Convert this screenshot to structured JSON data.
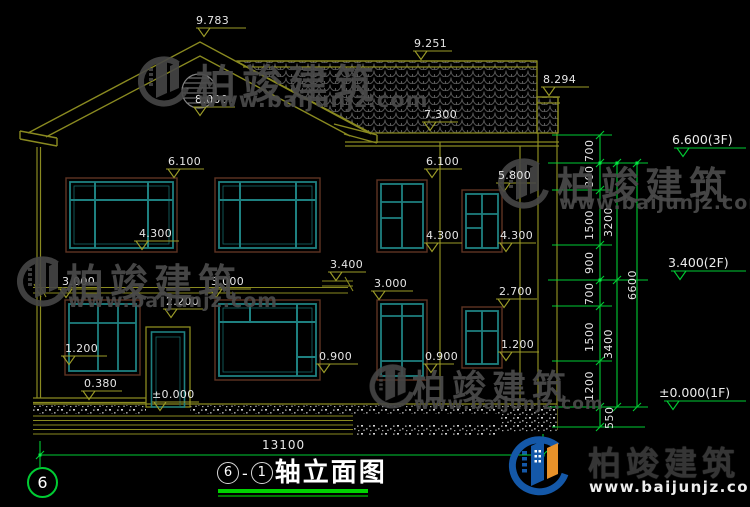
{
  "title_block": {
    "axis_from": "6",
    "dash": "-",
    "axis_to": "1",
    "title": "轴立面图",
    "axis_bubble": "6"
  },
  "dimensions": {
    "overall_width": "13100",
    "right_chain": [
      "700",
      "800",
      "1500",
      "900",
      "700",
      "1500",
      "1200",
      "550"
    ],
    "right_subtotals": [
      "3200",
      "3400"
    ],
    "right_total": "6600"
  },
  "floor_marks": [
    "6.600(3F)",
    "3.400(2F)",
    "±0.000(1F)"
  ],
  "levels": {
    "ridge": "9.783",
    "rear_ridge": "9.251",
    "side_roof": "8.294",
    "gable_vent": "8.000",
    "eave": "7.300",
    "w2f_left_top": "6.100",
    "w2f_mid_top": "6.100",
    "w2f_right_top": "5.800",
    "w2f_left_sill": "4.300",
    "w2f_mid_sill": "4.300",
    "w2f_right_sill": "4.300",
    "floor2": "3.400",
    "slab_left": "3.000",
    "slab_mid": "3.000",
    "w1f_right_top": "3.000",
    "w1f_small_top": "2.700",
    "door_top": "2.200",
    "w1f_left_sill": "1.200",
    "w1f_small_sill": "1.200",
    "w1f_mid_sill": "0.900",
    "w1f_right_sill": "0.900",
    "porch": "0.380",
    "ground": "±0.000"
  },
  "watermark": {
    "brand": "柏竣建筑",
    "url": "www.baijunjz.com"
  },
  "colors": {
    "line_olive": "#8a8a20",
    "line_green": "#00cc33",
    "window_teal": "#1e8080",
    "window_frame_brown": "#5e3423",
    "text_white": "#e6e6e6",
    "watermark_gray": "#4b4b4b",
    "logo_blue": "#1458a8",
    "logo_orange": "#e8922a"
  }
}
